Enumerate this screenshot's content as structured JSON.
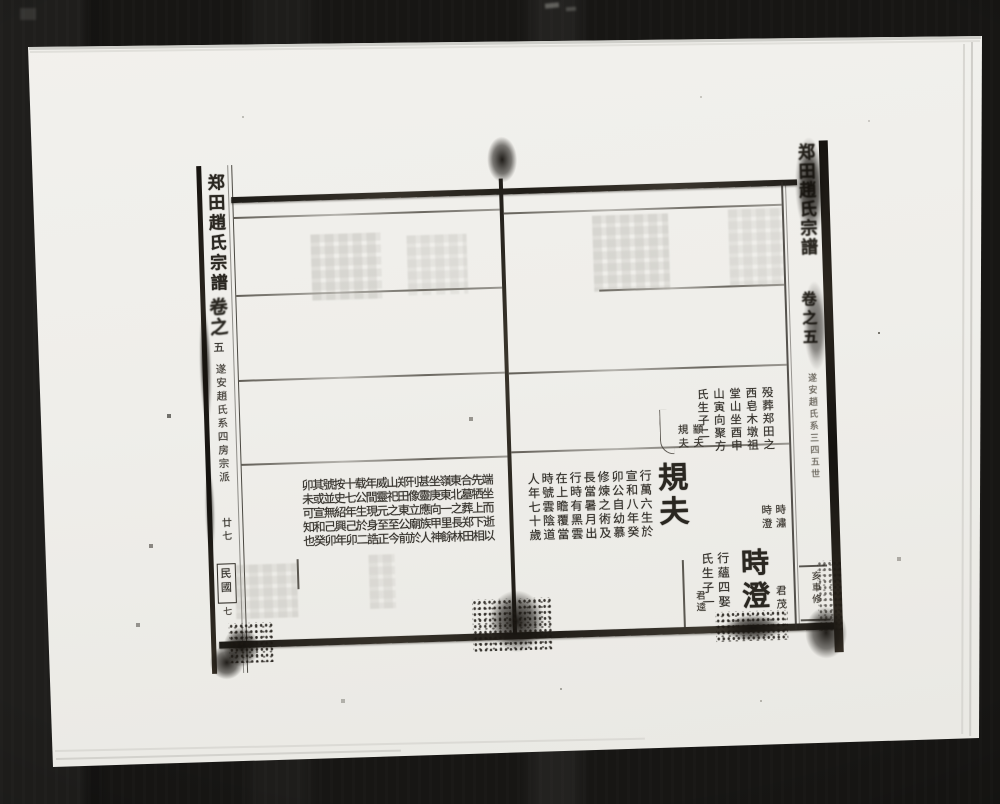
{
  "colors": {
    "ink": "#26231e",
    "paper": "#efeeea",
    "background": "#171614"
  },
  "spine_left": {
    "title": "郑田趙氏宗譜",
    "volume": "卷之",
    "volume_no": "五",
    "series": "遂安趙氏系四房宗派",
    "upper_note": "廿七",
    "era": "民國",
    "era_no": "七"
  },
  "spine_right": {
    "title": "郑田趙氏宗譜",
    "volume": "卷之五",
    "series": "遂安趙氏系三四五世",
    "fold_note": "亥車修"
  },
  "left_page": {
    "text_columns": [
      "端坐而逝以",
      "先牺上下相",
      "合墓葬郑田",
      "東北之長林",
      "嶺東一里餘",
      "坐庚向甲神",
      "甚靈應族人",
      "刊像立廟於",
      "郑田東公前",
      "山祀之至今",
      "威靈元至正",
      "年間現身誥",
      "载公生於二",
      "十七年己卯",
      "按史紹興年",
      "號並無己卯",
      "其或宣和癸",
      "卯未可知也"
    ]
  },
  "right_page": {
    "upper_block_columns": [
      "殁葬郑田之",
      "西皂木墩祖",
      "堂山坐酉申",
      "山寅向聚方",
      "氏生子二"
    ],
    "upper_sons": [
      "顓夫",
      "規夫"
    ],
    "entry1": {
      "name": "規夫",
      "detail_columns": [
        "行萬六生於",
        "宣和八年癸",
        "卯公自幼慕",
        "修煉之術及",
        "長當暑月出",
        "行時有黑雲",
        "在上瞻覆當",
        "時號雲陰道",
        "人年七十歲"
      ],
      "sons": [
        "時潚",
        "時澄"
      ]
    },
    "entry2": {
      "name": "時澄",
      "detail_columns": [
        "行蘊四娶",
        "氏生子一"
      ],
      "son_small": "君逵",
      "margin_small": "君茂"
    }
  }
}
